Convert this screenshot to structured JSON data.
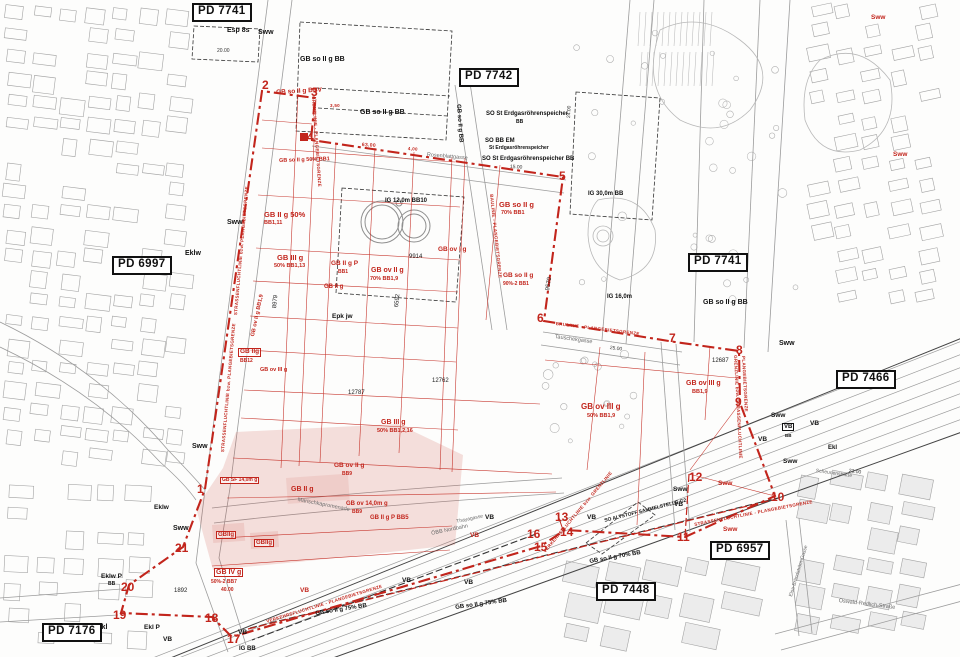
{
  "map": {
    "colors": {
      "plan_red": "#c2251c",
      "pink_zone_fill": "rgba(201,60,47,0.16)",
      "ink": "#1a1a1a",
      "line_gray": "#9c9c9c"
    },
    "labels": [
      {
        "t": "PD 7741",
        "x": 192,
        "y": 3,
        "k": "pd"
      },
      {
        "t": "PD 7742",
        "x": 459,
        "y": 68,
        "k": "pd"
      },
      {
        "t": "PD 6997",
        "x": 112,
        "y": 256,
        "k": "pd"
      },
      {
        "t": "PD 7741",
        "x": 688,
        "y": 253,
        "k": "pd"
      },
      {
        "t": "PD 7466",
        "x": 836,
        "y": 370,
        "k": "pd"
      },
      {
        "t": "PD 6957",
        "x": 710,
        "y": 541,
        "k": "pd"
      },
      {
        "t": "PD 7448",
        "x": 596,
        "y": 582,
        "k": "pd"
      },
      {
        "t": "PD 7176",
        "x": 42,
        "y": 623,
        "k": "pd"
      },
      {
        "t": "1",
        "x": 197,
        "y": 483,
        "k": "num"
      },
      {
        "t": "2",
        "x": 262,
        "y": 79,
        "k": "num"
      },
      {
        "t": "3",
        "x": 311,
        "y": 86,
        "k": "num"
      },
      {
        "t": "4",
        "x": 307,
        "y": 131,
        "k": "num"
      },
      {
        "t": "5",
        "x": 559,
        "y": 170,
        "k": "num"
      },
      {
        "t": "6",
        "x": 537,
        "y": 312,
        "k": "num"
      },
      {
        "t": "7",
        "x": 669,
        "y": 332,
        "k": "num"
      },
      {
        "t": "8",
        "x": 736,
        "y": 344,
        "k": "num"
      },
      {
        "t": "9",
        "x": 735,
        "y": 396,
        "k": "num"
      },
      {
        "t": "10",
        "x": 771,
        "y": 491,
        "k": "num"
      },
      {
        "t": "11",
        "x": 677,
        "y": 531,
        "k": "num"
      },
      {
        "t": "12",
        "x": 689,
        "y": 471,
        "k": "num"
      },
      {
        "t": "13",
        "x": 555,
        "y": 511,
        "k": "num"
      },
      {
        "t": "14",
        "x": 560,
        "y": 526,
        "k": "num"
      },
      {
        "t": "15",
        "x": 534,
        "y": 541,
        "k": "num"
      },
      {
        "t": "16",
        "x": 527,
        "y": 528,
        "k": "num"
      },
      {
        "t": "17",
        "x": 227,
        "y": 633,
        "k": "num"
      },
      {
        "t": "18",
        "x": 205,
        "y": 612,
        "k": "num"
      },
      {
        "t": "19",
        "x": 113,
        "y": 609,
        "k": "num"
      },
      {
        "t": "20",
        "x": 121,
        "y": 581,
        "k": "num"
      },
      {
        "t": "21",
        "x": 175,
        "y": 542,
        "k": "num"
      },
      {
        "t": "GB so II g BBV",
        "x": 276,
        "y": 90,
        "k": "red",
        "s": 6.5,
        "r": -3
      },
      {
        "t": "GB so II g 50% BB1",
        "x": 279,
        "y": 159,
        "k": "red",
        "s": 5.5,
        "r": -2
      },
      {
        "t": "GB II g 50%",
        "x": 264,
        "y": 211,
        "k": "red",
        "s": 7.5
      },
      {
        "t": "BB1,11",
        "x": 264,
        "y": 221,
        "k": "red",
        "s": 5.5
      },
      {
        "t": "GB III g",
        "x": 277,
        "y": 254,
        "k": "red",
        "s": 7.5
      },
      {
        "t": "50% BB1,13",
        "x": 274,
        "y": 264,
        "k": "red",
        "s": 5.5
      },
      {
        "t": "GB II g P",
        "x": 331,
        "y": 261,
        "k": "red",
        "s": 6.5
      },
      {
        "t": "BB1",
        "x": 338,
        "y": 270,
        "k": "red",
        "s": 5
      },
      {
        "t": "GB ov II g",
        "x": 371,
        "y": 267,
        "k": "red",
        "s": 7
      },
      {
        "t": "70% BB1,9",
        "x": 370,
        "y": 277,
        "k": "red",
        "s": 5.5
      },
      {
        "t": "GB ov I g",
        "x": 438,
        "y": 247,
        "k": "red",
        "s": 6.5
      },
      {
        "t": "GB II g",
        "x": 324,
        "y": 284,
        "k": "red",
        "s": 6
      },
      {
        "t": "GB so II g",
        "x": 499,
        "y": 201,
        "k": "red",
        "s": 7.5
      },
      {
        "t": "70% BB1",
        "x": 501,
        "y": 211,
        "k": "red",
        "s": 5.5
      },
      {
        "t": "GB so II g",
        "x": 503,
        "y": 273,
        "k": "red",
        "s": 6.5
      },
      {
        "t": "90%-2 BB1",
        "x": 503,
        "y": 282,
        "k": "red",
        "s": 5
      },
      {
        "t": "GB ov II g BB1,9",
        "x": 251,
        "y": 336,
        "k": "red",
        "s": 5.5,
        "r": -78
      },
      {
        "t": "GB IIg",
        "x": 238,
        "y": 348,
        "k": "red",
        "s": 6.5,
        "box": true
      },
      {
        "t": "BB12",
        "x": 240,
        "y": 359,
        "k": "red",
        "s": 5
      },
      {
        "t": "GB ov III g",
        "x": 260,
        "y": 368,
        "k": "red",
        "s": 5.5
      },
      {
        "t": "GB III g",
        "x": 381,
        "y": 419,
        "k": "red",
        "s": 7
      },
      {
        "t": "50% BB1,2,16",
        "x": 377,
        "y": 429,
        "k": "red",
        "s": 5.5
      },
      {
        "t": "GB ov  III  g",
        "x": 581,
        "y": 403,
        "k": "red",
        "s": 8
      },
      {
        "t": "50%    BB1,9",
        "x": 587,
        "y": 414,
        "k": "red",
        "s": 5.5
      },
      {
        "t": "GB ov III g",
        "x": 686,
        "y": 380,
        "k": "red",
        "s": 7
      },
      {
        "t": "BB1,9",
        "x": 692,
        "y": 390,
        "k": "red",
        "s": 5.5
      },
      {
        "t": "GB IV g",
        "x": 214,
        "y": 568,
        "k": "red",
        "s": 7,
        "box": true
      },
      {
        "t": "50%-2  BB7",
        "x": 211,
        "y": 580,
        "k": "red",
        "s": 5
      },
      {
        "t": "40.00",
        "x": 221,
        "y": 588,
        "k": "red",
        "s": 5
      },
      {
        "t": "GBIIg",
        "x": 216,
        "y": 531,
        "k": "red",
        "s": 6,
        "box": true
      },
      {
        "t": "GBIIg",
        "x": 254,
        "y": 539,
        "k": "red",
        "s": 6,
        "box": true
      },
      {
        "t": "GB II g",
        "x": 291,
        "y": 486,
        "k": "red",
        "s": 7
      },
      {
        "t": "GB ov II g",
        "x": 334,
        "y": 463,
        "k": "red",
        "s": 6.5
      },
      {
        "t": "BB9",
        "x": 342,
        "y": 472,
        "k": "red",
        "s": 5
      },
      {
        "t": "GB ov 14,0m g",
        "x": 346,
        "y": 501,
        "k": "red",
        "s": 6
      },
      {
        "t": "BB9",
        "x": 352,
        "y": 510,
        "k": "red",
        "s": 5
      },
      {
        "t": "GB SF 14,0m g",
        "x": 220,
        "y": 477,
        "k": "red",
        "s": 5,
        "box": true
      },
      {
        "t": "GB II g P BB5",
        "x": 370,
        "y": 515,
        "k": "red",
        "s": 6
      },
      {
        "t": "VB",
        "x": 470,
        "y": 533,
        "k": "red",
        "s": 6.5
      },
      {
        "t": "VB",
        "x": 300,
        "y": 588,
        "k": "red",
        "s": 6.5
      },
      {
        "t": "Sww",
        "x": 718,
        "y": 481,
        "k": "red",
        "s": 6.5
      },
      {
        "t": "Sww",
        "x": 723,
        "y": 527,
        "k": "red",
        "s": 6.5
      },
      {
        "t": "Sww",
        "x": 871,
        "y": 15,
        "k": "red",
        "s": 6.5
      },
      {
        "t": "Sww",
        "x": 893,
        "y": 152,
        "k": "red",
        "s": 6.5
      },
      {
        "t": "GRENZLINIE - PLANGEBIETSGRENZE",
        "x": 315,
        "y": 96,
        "k": "ann",
        "s": 4.5,
        "r": 86
      },
      {
        "t": "BAULINIE - PLANGEBIETSGRENZE",
        "x": 493,
        "y": 194,
        "k": "ann",
        "s": 4.5,
        "r": 84
      },
      {
        "t": "BAULINIE - PLANGEBIETSGRENZE",
        "x": 556,
        "y": 322,
        "k": "ann",
        "s": 4.5,
        "r": 7
      },
      {
        "t": "STRASSENFLUCHTLINIE bzw. PLANGEBIETSGRENZE",
        "x": 234,
        "y": 315,
        "k": "ann",
        "s": 4.5,
        "r": -85
      },
      {
        "t": "STRASSENFLUCHTLINIE bzw. PLANGEBIETSGRENZE",
        "x": 221,
        "y": 452,
        "k": "ann",
        "s": 4.5,
        "r": -85
      },
      {
        "t": "VERKEHRSFLUCHTLINIE - PLANGEBIETSGRENZE",
        "x": 266,
        "y": 620,
        "k": "ann",
        "s": 4.5,
        "r": -17
      },
      {
        "t": "VERKEHRSFLUCHTLINIE bzw. GRENZLINIE",
        "x": 543,
        "y": 551,
        "k": "ann",
        "s": 4.5,
        "r": -50
      },
      {
        "t": "STRASSENFLUCHTLINIE - PLANGEBIETSGRENZE",
        "x": 694,
        "y": 523,
        "k": "ann",
        "s": 4.5,
        "r": -11
      },
      {
        "t": "GRENZLINIE bzw. STRASSENFLUCHTLINIE",
        "x": 737,
        "y": 355,
        "k": "ann",
        "s": 4.5,
        "r": 87
      },
      {
        "t": "PLANGEBIETSGRENZE",
        "x": 745,
        "y": 356,
        "k": "ann",
        "s": 4.5,
        "r": 87
      },
      {
        "t": "63.00",
        "x": 362,
        "y": 143,
        "k": "ann",
        "s": 5,
        "r": 4
      },
      {
        "t": "4,00",
        "x": 408,
        "y": 147,
        "k": "ann",
        "s": 4.5,
        "r": 4
      },
      {
        "t": "3,50",
        "x": 330,
        "y": 104,
        "k": "ann",
        "s": 4.5
      },
      {
        "t": "Esp 8s",
        "x": 227,
        "y": 27,
        "k": "blk",
        "s": 7
      },
      {
        "t": "GB so II g BB",
        "x": 300,
        "y": 56,
        "k": "blk",
        "s": 7
      },
      {
        "t": "GB so II g BB",
        "x": 360,
        "y": 109,
        "k": "blk",
        "s": 7
      },
      {
        "t": "GB so II g BB",
        "x": 461,
        "y": 104,
        "k": "blk",
        "s": 6,
        "r": 86
      },
      {
        "t": "SO St Erdgasröhrenspeicher",
        "x": 486,
        "y": 111,
        "k": "blk",
        "s": 6
      },
      {
        "t": "BB",
        "x": 516,
        "y": 120,
        "k": "blk",
        "s": 5
      },
      {
        "t": "SO BB EM",
        "x": 485,
        "y": 138,
        "k": "blk",
        "s": 6
      },
      {
        "t": "St Erdgasröhrenspeicher",
        "x": 489,
        "y": 146,
        "k": "blk",
        "s": 5
      },
      {
        "t": "SO St Erdgasröhrenspeicher BB",
        "x": 482,
        "y": 156,
        "k": "blk",
        "s": 6
      },
      {
        "t": "IG 12,0m BB10",
        "x": 385,
        "y": 198,
        "k": "blk",
        "s": 6
      },
      {
        "t": "IG 30,0m BB",
        "x": 588,
        "y": 191,
        "k": "blk",
        "s": 6
      },
      {
        "t": "IG 16,0m",
        "x": 607,
        "y": 294,
        "k": "blk",
        "s": 6
      },
      {
        "t": "IG BB",
        "x": 239,
        "y": 646,
        "k": "blk",
        "s": 6
      },
      {
        "t": "GB so II g BB",
        "x": 703,
        "y": 299,
        "k": "blk",
        "s": 7
      },
      {
        "t": "SO ALTSTOFF SAMMELSTELLE G2",
        "x": 604,
        "y": 519,
        "k": "blk",
        "s": 5,
        "r": -14
      },
      {
        "t": "GB so II g 70% BB",
        "x": 589,
        "y": 559,
        "k": "blk",
        "s": 6,
        "r": -10
      },
      {
        "t": "GB so II g 75% BB",
        "x": 315,
        "y": 611,
        "k": "blk",
        "s": 6,
        "r": -9
      },
      {
        "t": "GB so II g 75% BB",
        "x": 455,
        "y": 605,
        "k": "blk",
        "s": 6,
        "r": -8
      },
      {
        "t": "Epk jw",
        "x": 332,
        "y": 314,
        "k": "blk",
        "s": 6.5
      },
      {
        "t": "Sww",
        "x": 258,
        "y": 29,
        "k": "blk",
        "s": 7
      },
      {
        "t": "Sww",
        "x": 227,
        "y": 219,
        "k": "blk",
        "s": 7
      },
      {
        "t": "Sww",
        "x": 192,
        "y": 443,
        "k": "blk",
        "s": 7
      },
      {
        "t": "Sww",
        "x": 173,
        "y": 525,
        "k": "blk",
        "s": 7
      },
      {
        "t": "Sww",
        "x": 779,
        "y": 340,
        "k": "blk",
        "s": 7
      },
      {
        "t": "Sww",
        "x": 771,
        "y": 413,
        "k": "blk",
        "s": 6.5
      },
      {
        "t": "Sww",
        "x": 783,
        "y": 459,
        "k": "blk",
        "s": 6.5
      },
      {
        "t": "Sww",
        "x": 673,
        "y": 487,
        "k": "blk",
        "s": 6.5
      },
      {
        "t": "Eklw",
        "x": 185,
        "y": 250,
        "k": "blk",
        "s": 7
      },
      {
        "t": "Eklw",
        "x": 154,
        "y": 505,
        "k": "blk",
        "s": 6.5
      },
      {
        "t": "Eklw P",
        "x": 101,
        "y": 574,
        "k": "blk",
        "s": 6.5
      },
      {
        "t": "BB",
        "x": 108,
        "y": 582,
        "k": "blk",
        "s": 5
      },
      {
        "t": "Ekl",
        "x": 97,
        "y": 624,
        "k": "blk",
        "s": 7
      },
      {
        "t": "Ekl P",
        "x": 144,
        "y": 625,
        "k": "blk",
        "s": 6.5
      },
      {
        "t": "Ekl",
        "x": 828,
        "y": 445,
        "k": "blk",
        "s": 6
      },
      {
        "t": "VB",
        "x": 485,
        "y": 515,
        "k": "blk",
        "s": 6.5
      },
      {
        "t": "VB",
        "x": 587,
        "y": 515,
        "k": "blk",
        "s": 6.5
      },
      {
        "t": "VB",
        "x": 674,
        "y": 502,
        "k": "blk",
        "s": 6.5
      },
      {
        "t": "VB",
        "x": 464,
        "y": 580,
        "k": "blk",
        "s": 6.5
      },
      {
        "t": "VB",
        "x": 758,
        "y": 437,
        "k": "blk",
        "s": 6.5
      },
      {
        "t": "VB",
        "x": 810,
        "y": 421,
        "k": "blk",
        "s": 6.5
      },
      {
        "t": "VB",
        "x": 163,
        "y": 637,
        "k": "blk",
        "s": 6.5
      },
      {
        "t": "VB",
        "x": 238,
        "y": 630,
        "k": "blk",
        "s": 6.5
      },
      {
        "t": "VB",
        "x": 402,
        "y": 578,
        "k": "blk",
        "s": 6.5
      },
      {
        "t": "VB",
        "x": 782,
        "y": 423,
        "k": "blk",
        "s": 6,
        "box": true
      },
      {
        "t": "BB",
        "x": 785,
        "y": 434,
        "k": "blk",
        "s": 4.5
      },
      {
        "t": "1892",
        "x": 174,
        "y": 588,
        "k": "parcel",
        "s": 6
      },
      {
        "t": "12687",
        "x": 712,
        "y": 358,
        "k": "parcel",
        "s": 6
      },
      {
        "t": "9914",
        "x": 409,
        "y": 254,
        "k": "parcel",
        "s": 6
      },
      {
        "t": "12787",
        "x": 348,
        "y": 390,
        "k": "parcel",
        "s": 6
      },
      {
        "t": "12762",
        "x": 432,
        "y": 378,
        "k": "parcel",
        "s": 6
      },
      {
        "t": "9570",
        "x": 545,
        "y": 290,
        "k": "parcel",
        "s": 6,
        "r": -80
      },
      {
        "t": "8979",
        "x": 272,
        "y": 308,
        "k": "parcel",
        "s": 6,
        "r": -84
      },
      {
        "t": "6592",
        "x": 394,
        "y": 307,
        "k": "parcel",
        "s": 6,
        "r": -84
      },
      {
        "t": "25.00",
        "x": 610,
        "y": 346,
        "k": "dim",
        "s": 5,
        "r": 7
      },
      {
        "t": "23.00",
        "x": 849,
        "y": 469,
        "k": "dim",
        "s": 5,
        "r": 8
      },
      {
        "t": "24.00",
        "x": 567,
        "y": 118,
        "k": "dim",
        "s": 5,
        "r": -87
      },
      {
        "t": "20.00",
        "x": 217,
        "y": 49,
        "k": "dim",
        "s": 5
      },
      {
        "t": "15.00",
        "x": 510,
        "y": 165,
        "k": "dim",
        "s": 5,
        "r": 3
      },
      {
        "t": "Rosenblattgasse",
        "x": 427,
        "y": 153,
        "k": "street",
        "s": 5.5,
        "r": 5
      },
      {
        "t": "Tauschekgasse",
        "x": 555,
        "y": 335,
        "k": "street",
        "s": 5.5,
        "r": 8
      },
      {
        "t": "Marischkapromenade",
        "x": 298,
        "y": 498,
        "k": "street",
        "s": 5.5,
        "r": 11
      },
      {
        "t": "Oswald-Redlich-Straße",
        "x": 839,
        "y": 599,
        "k": "street",
        "s": 5.5,
        "r": 7
      },
      {
        "t": "Elsa-Brändström-Gasse",
        "x": 789,
        "y": 596,
        "k": "street",
        "s": 5,
        "r": -73
      },
      {
        "t": "ÖBB Nordbahn",
        "x": 431,
        "y": 532,
        "k": "street",
        "s": 5.5,
        "r": -12
      },
      {
        "t": "Thayagasse",
        "x": 456,
        "y": 520,
        "k": "street",
        "s": 5,
        "r": -12
      },
      {
        "t": "Scheunenstraße",
        "x": 816,
        "y": 469,
        "k": "street",
        "s": 5,
        "r": 8
      }
    ]
  }
}
